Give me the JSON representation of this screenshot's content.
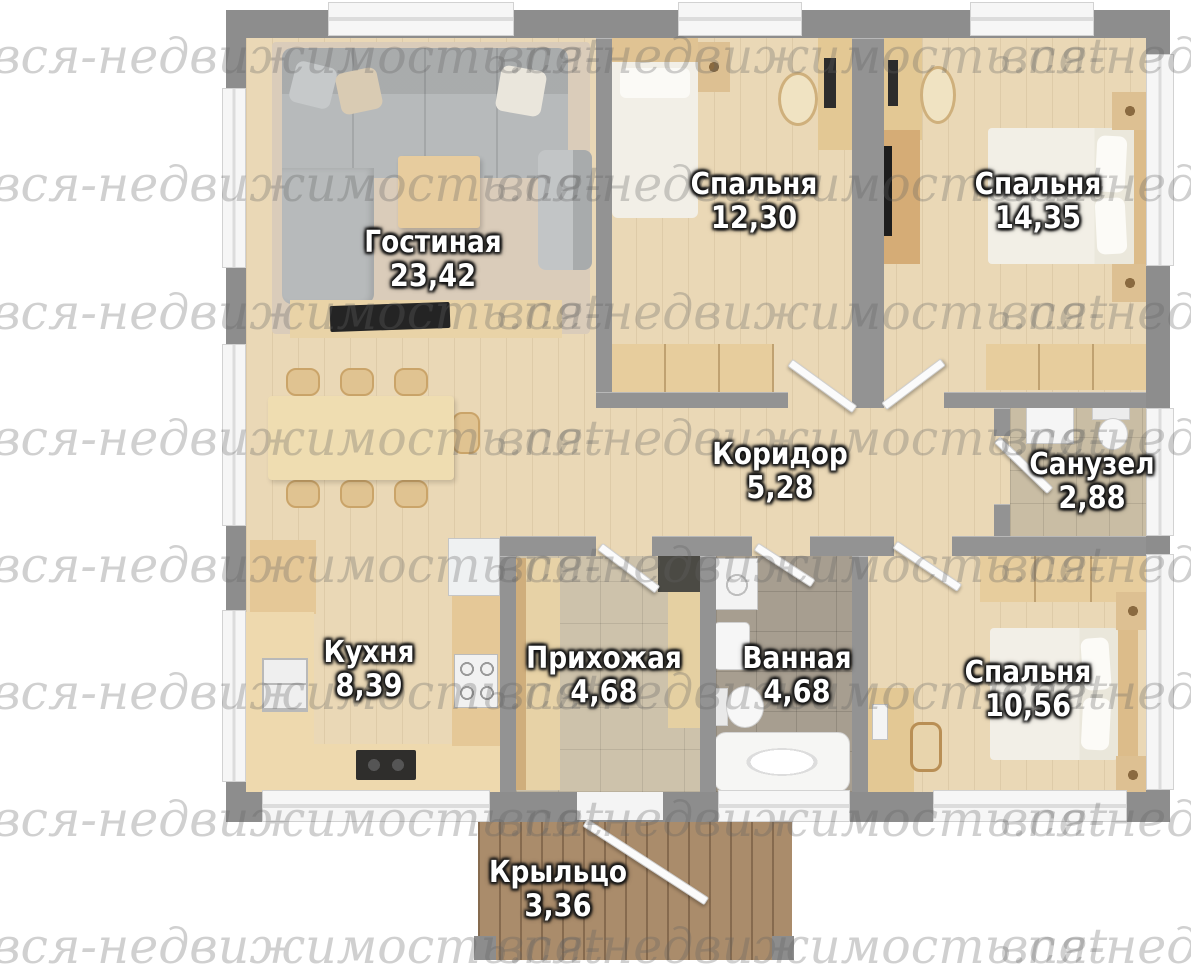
{
  "image_type": "house-floor-plan-render",
  "watermark": {
    "text": "вся-недвижимость.net"
  },
  "rooms": [
    {
      "id": "living",
      "name": "Гостиная",
      "area": "23,42"
    },
    {
      "id": "bedroom-top-middle",
      "name": "Спальня",
      "area": "12,30"
    },
    {
      "id": "bedroom-top-right",
      "name": "Спальня",
      "area": "14,35"
    },
    {
      "id": "corridor",
      "name": "Коридор",
      "area": "5,28"
    },
    {
      "id": "wc",
      "name": "Санузел",
      "area": "2,88"
    },
    {
      "id": "kitchen",
      "name": "Кухня",
      "area": "8,39"
    },
    {
      "id": "hallway",
      "name": "Прихожая",
      "area": "4,68"
    },
    {
      "id": "bathroom",
      "name": "Ванная",
      "area": "4,68"
    },
    {
      "id": "bedroom-bottom-right",
      "name": "Спальня",
      "area": "10,56"
    },
    {
      "id": "porch",
      "name": "Крыльцо",
      "area": "3,36"
    }
  ],
  "palette": {
    "wall_gray": "#8d8d8d",
    "floor_wood": "#ead8b6",
    "living_carpet": "#daccba",
    "hallway_tile": "#cdc2ab",
    "bathroom_tile": "#a79e90",
    "wc_tile": "#c9bda4",
    "porch_wood": "#aa8c6b",
    "furniture_wood": "#e3c894",
    "sofa_gray": "#b7babb",
    "label_text": "#ffffff",
    "label_outline": "#151515"
  }
}
